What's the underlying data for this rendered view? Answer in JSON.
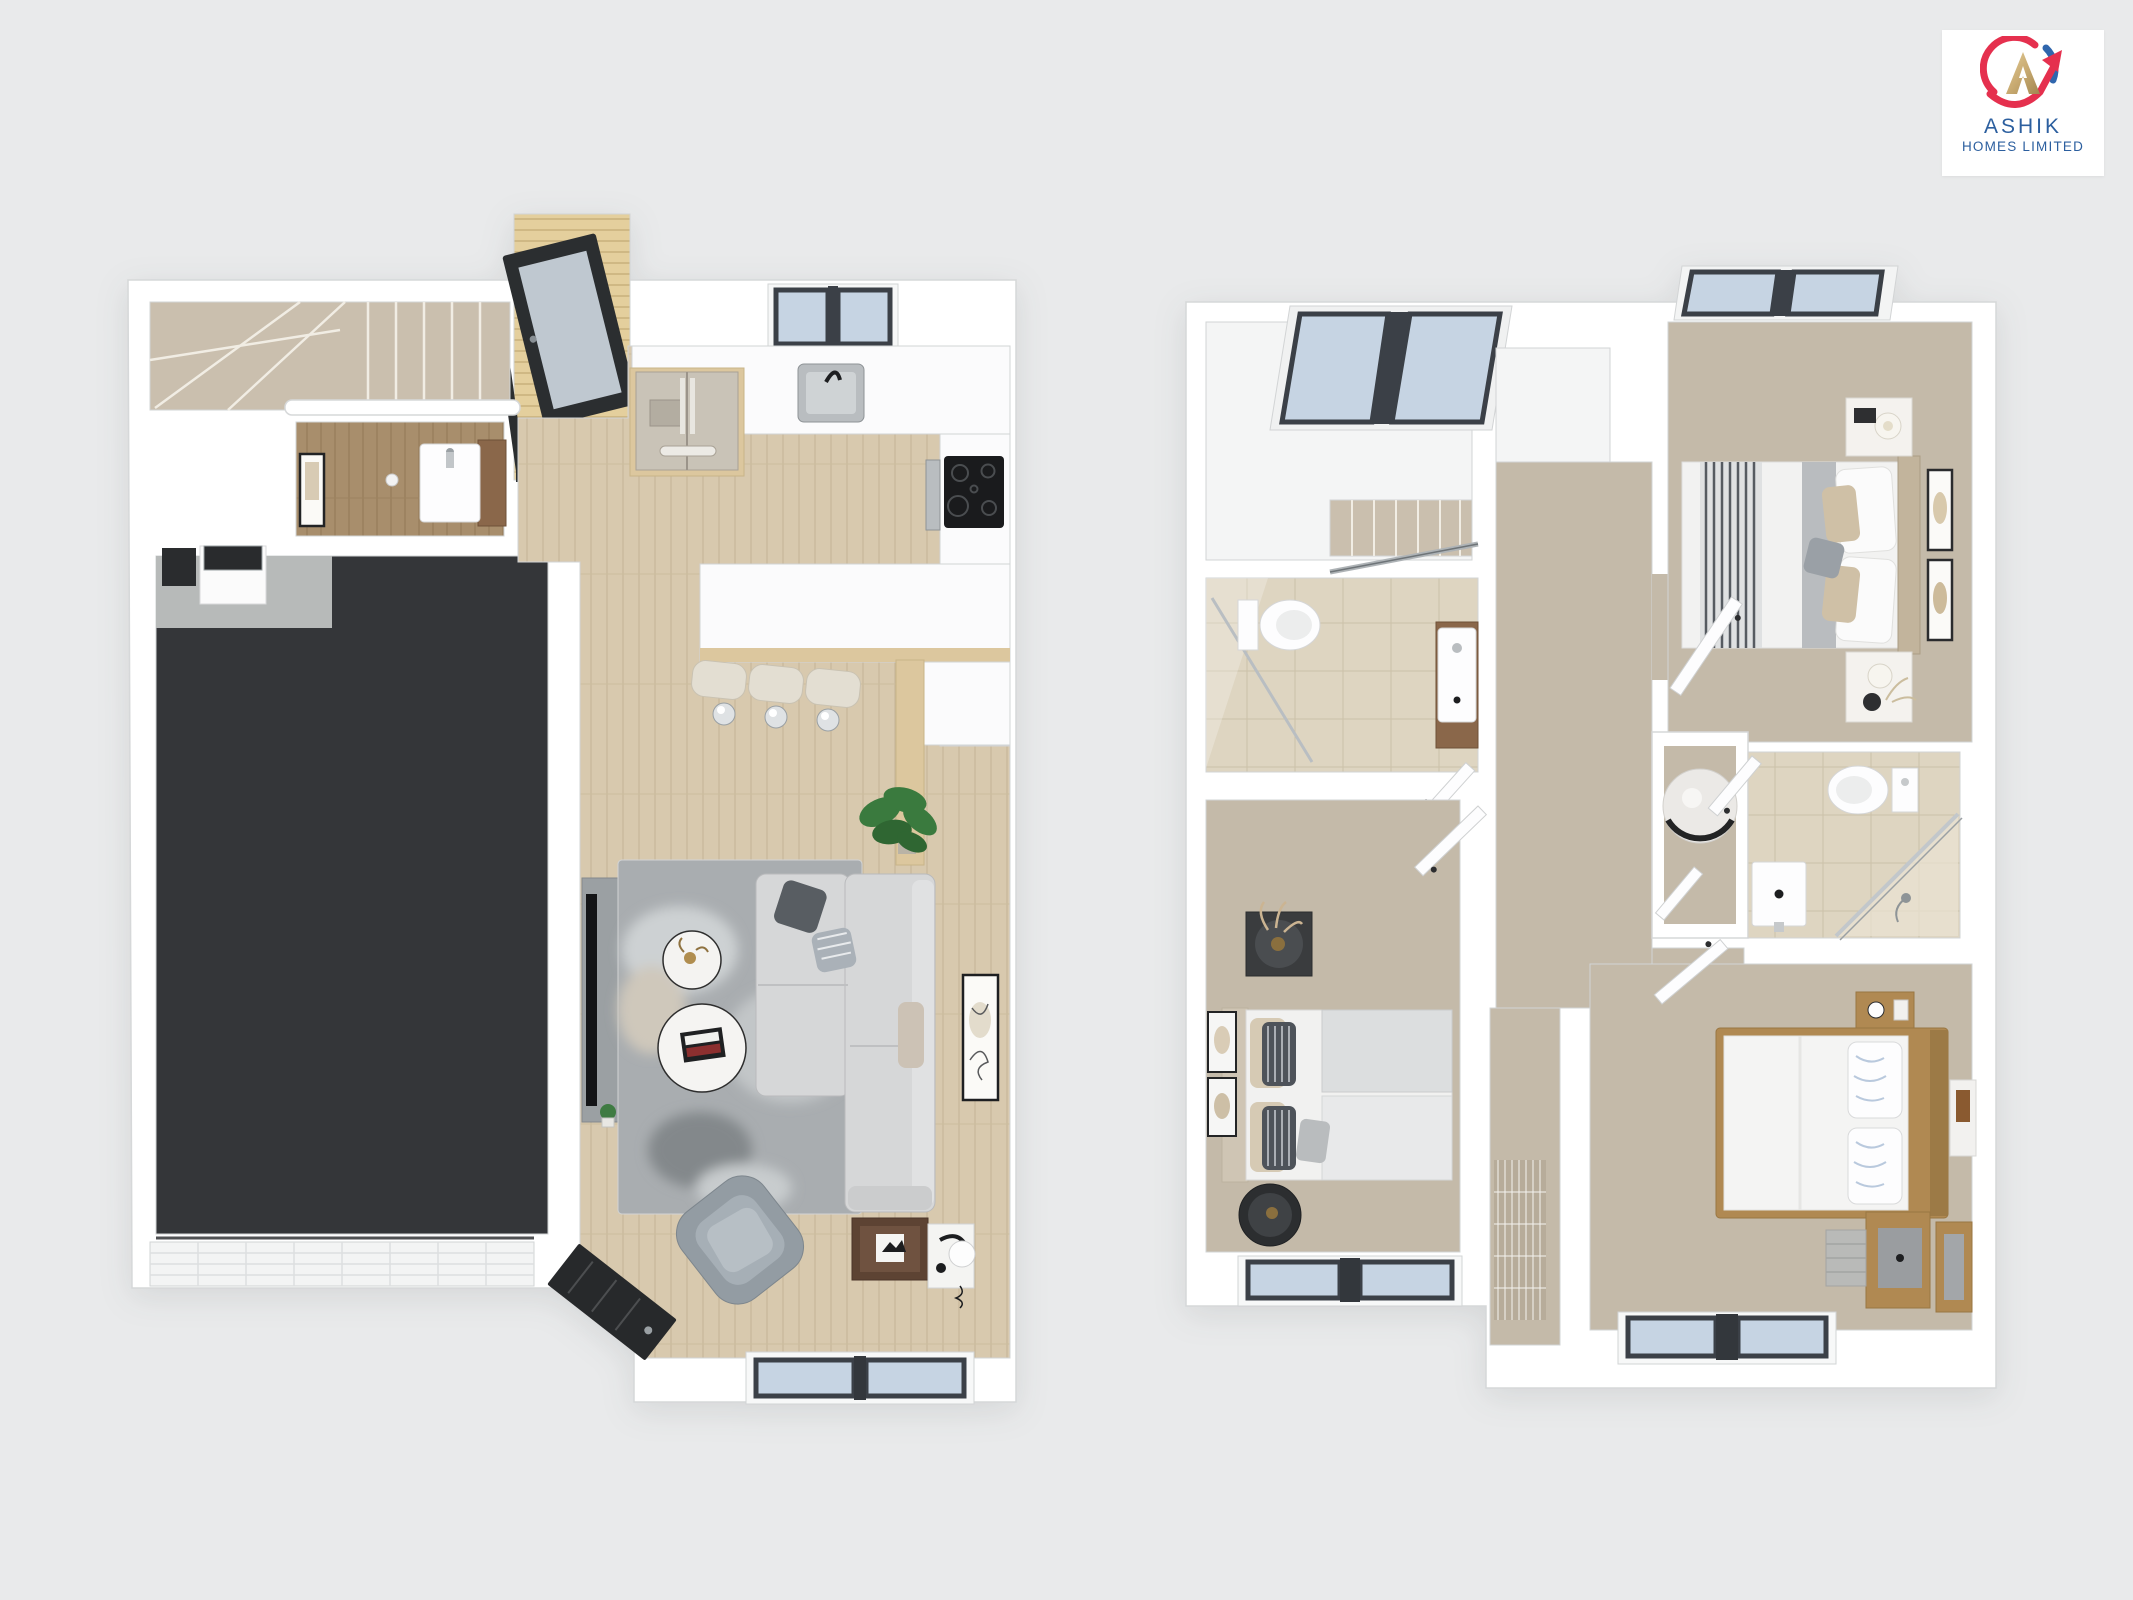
{
  "logo": {
    "company_line1": "ASHIK",
    "company_line2": "HOMES LIMITED",
    "text_color": "#2c5f9f",
    "emblem": {
      "monogram_letter": "A",
      "monogram_gold": "#c9ab72",
      "swoosh_red": "#e5304e",
      "arc_blue": "#2f66ad"
    }
  },
  "page": {
    "background_color": "#e9eaeb"
  },
  "palette": {
    "wall_white": "#ffffff",
    "floor_wood": "#d8c9ae",
    "floor_deck": "#e4cf9d",
    "floor_wc_wood": "#a88e6c",
    "floor_carpet": "#c4baa9",
    "floor_stairs_carpet": "#cabfae",
    "floor_tile": "#ded5c1",
    "floor_garage": "#343639",
    "floor_concrete": "#b7bab9",
    "rug_gray": "#a9adb0",
    "window_glass": "#c6d4e3",
    "window_frame_dark": "#3b4047",
    "sofa_gray": "#d6d7d8",
    "counter_white": "#fbfbfc",
    "cabinet_wood": "#dcc79e",
    "bed_frame_wood": "#b08952",
    "door_black": "#2b2e30"
  }
}
